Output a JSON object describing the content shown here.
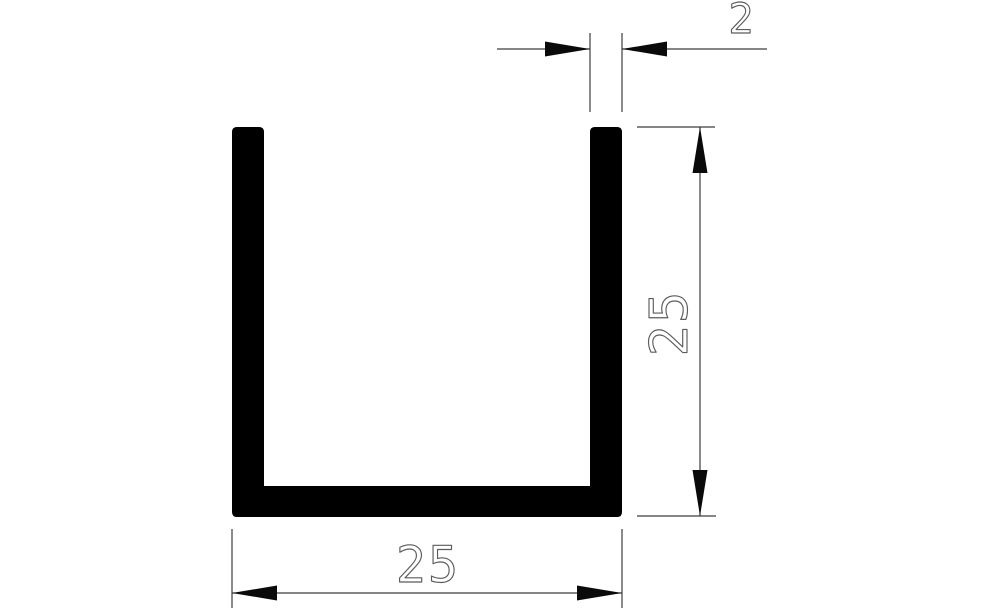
{
  "drawing": {
    "kind": "u-channel-profile-dimension-drawing",
    "colors": {
      "background": "#ffffff",
      "profile_fill": "#000000",
      "dimension_line": "#3d3d3d",
      "arrow_fill": "#0a0a0a",
      "text_stroke": "#5c5c5c"
    },
    "dimensions": {
      "wall_thickness": {
        "label": "2"
      },
      "height": {
        "label": "25"
      },
      "width": {
        "label": "25"
      }
    }
  }
}
